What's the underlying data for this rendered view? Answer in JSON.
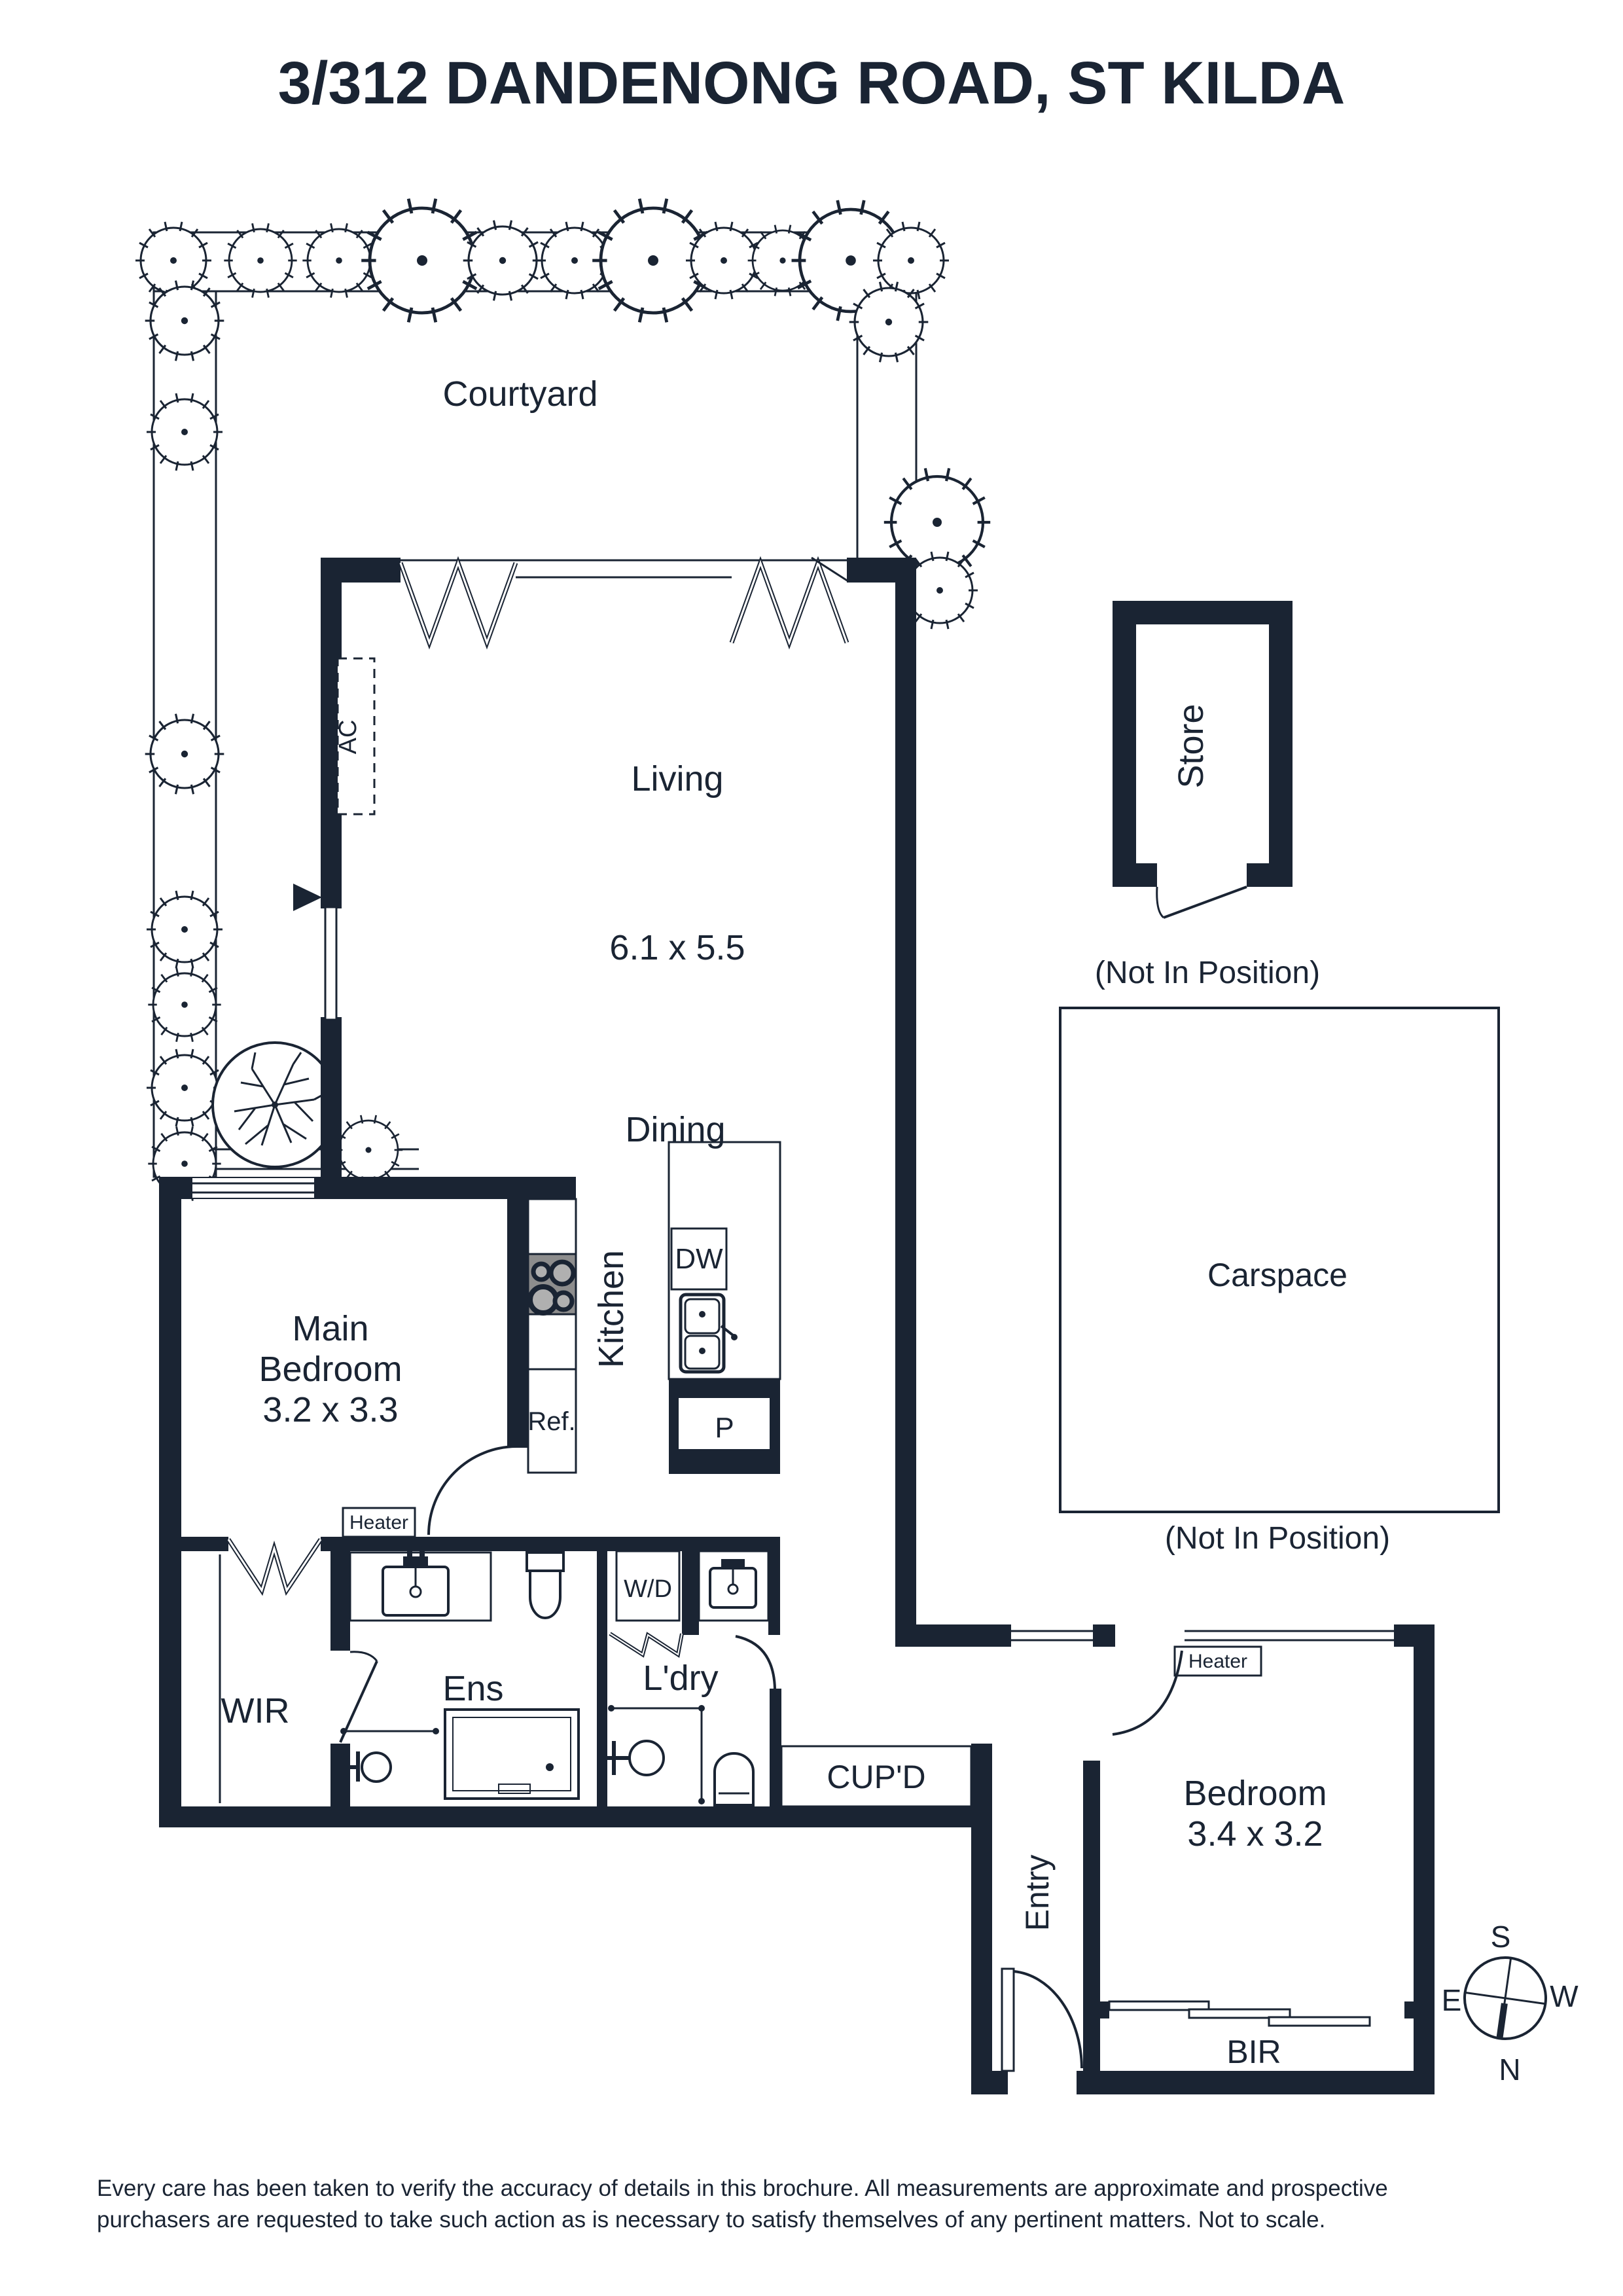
{
  "title": "3/312 DANDENONG ROAD, ST KILDA",
  "plan": {
    "courtyard": {
      "label": "Courtyard"
    },
    "living": {
      "label": "Living",
      "dims": "6.1 x 5.5"
    },
    "dining": {
      "label": "Dining"
    },
    "kitchen": {
      "label": "Kitchen",
      "dishwasher": "DW",
      "pantry": "P",
      "fridge": "Ref.",
      "ac": "AC"
    },
    "main_bedroom": {
      "label_line1": "Main",
      "label_line2": "Bedroom",
      "dims": "3.2 x 3.3",
      "heater": "Heater"
    },
    "wir": {
      "label": "WIR"
    },
    "ensuite": {
      "label": "Ens"
    },
    "laundry": {
      "label": "L'dry",
      "washer_dryer": "W/D"
    },
    "cupboard": {
      "label": "CUP'D"
    },
    "entry": {
      "label": "Entry"
    },
    "bedroom2": {
      "label": "Bedroom",
      "dims": "3.4 x 3.2",
      "bir": "BIR",
      "heater": "Heater"
    },
    "store": {
      "label": "Store",
      "note": "(Not In Position)"
    },
    "carspace": {
      "label": "Carspace",
      "note": "(Not In Position)"
    }
  },
  "compass": {
    "n": "N",
    "s": "S",
    "e": "E",
    "w": "W"
  },
  "disclaimer": {
    "line1": "Every care has been taken to verify the accuracy of details in this brochure. All measurements are approximate and prospective",
    "line2": "purchasers are requested to take such action as is necessary to satisfy themselves of any pertinent matters. Not to scale."
  },
  "colors": {
    "ink": "#1a2433",
    "cooktop": "#8d8d8d",
    "burner": "#b0b0b0",
    "paper": "#ffffff"
  }
}
